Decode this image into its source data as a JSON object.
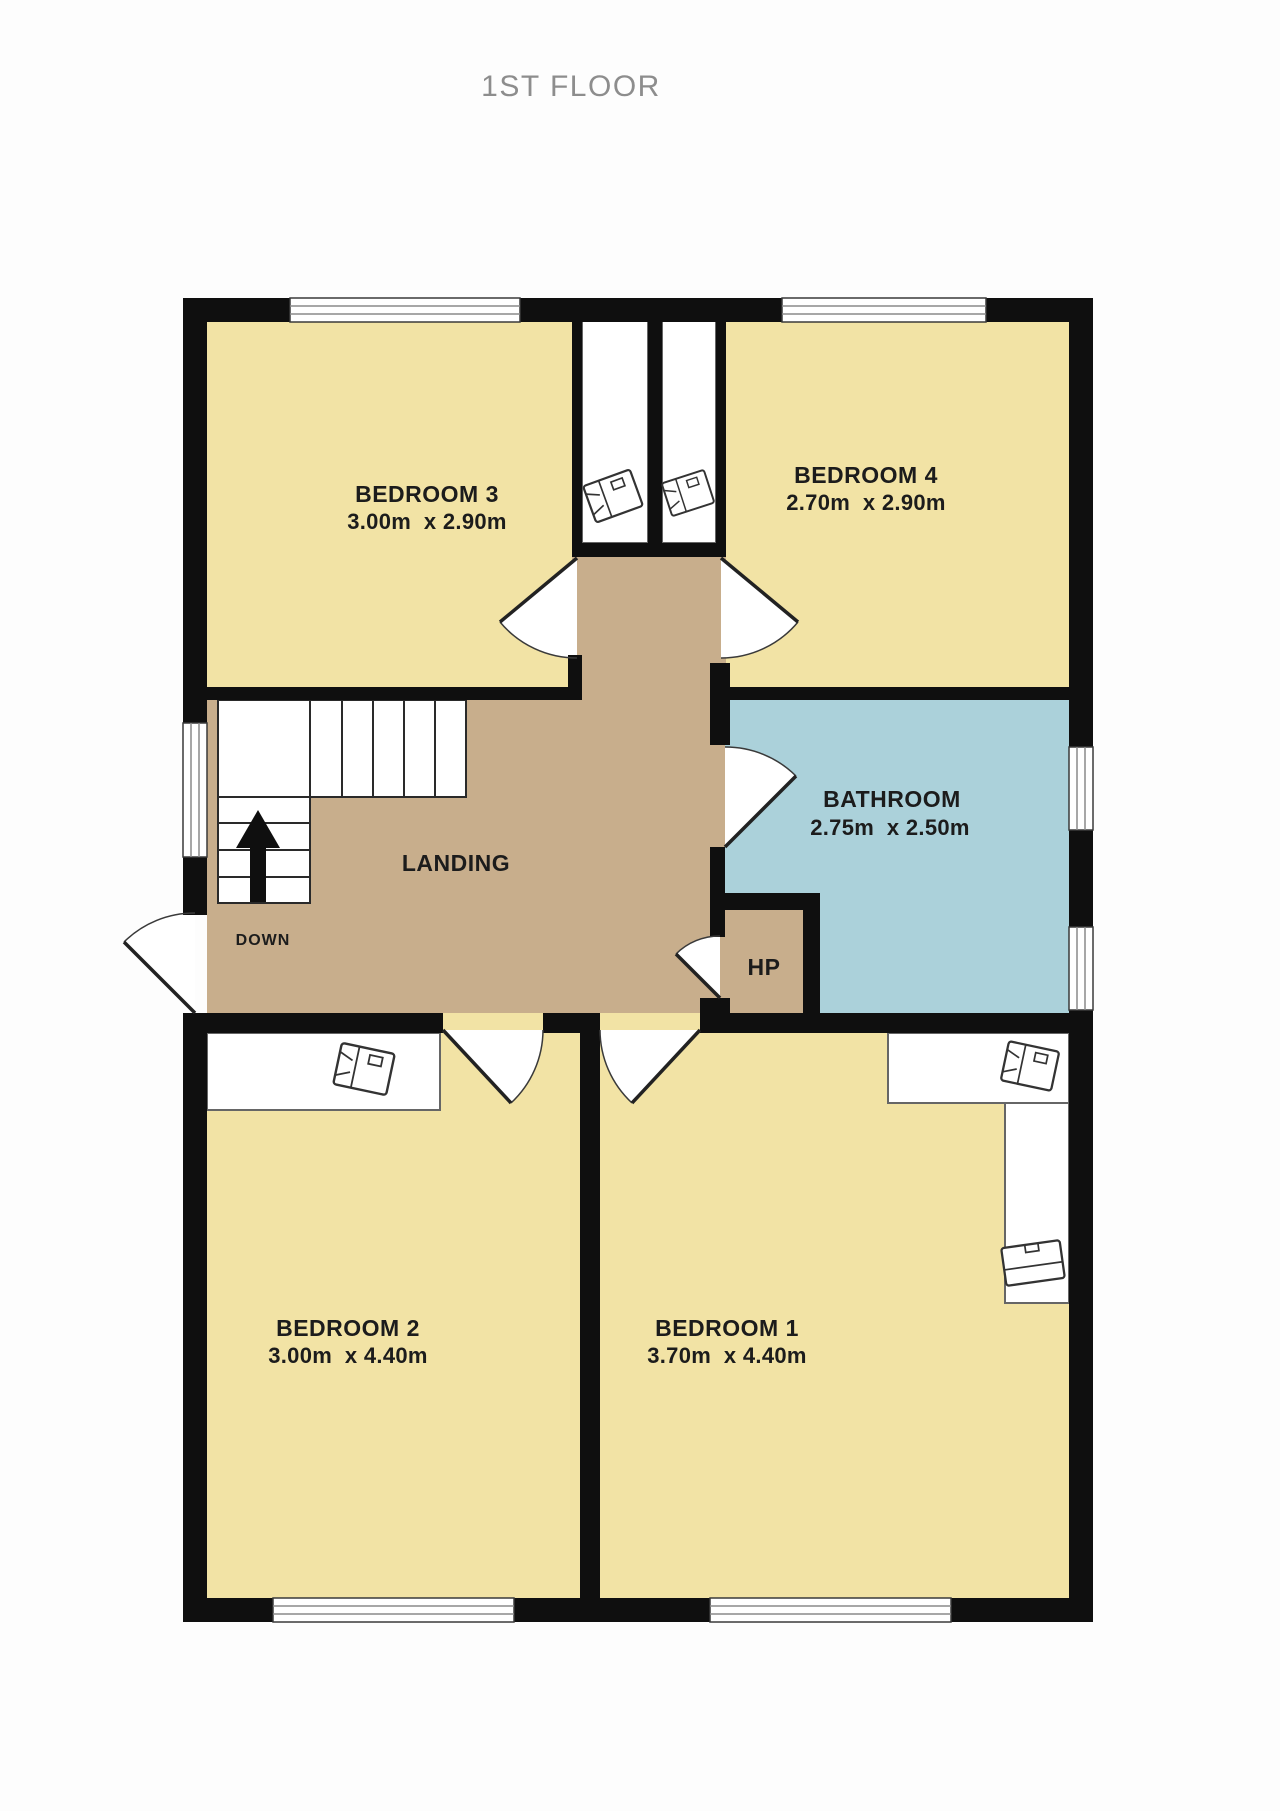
{
  "title": "1ST FLOOR",
  "colors": {
    "wall": "#0f0f0f",
    "bedroom_floor": "#F2E3A5",
    "landing_floor": "#C8AE8C",
    "bathroom_floor": "#ABD1DA",
    "title_text": "#8d8d8d",
    "label_text": "#1c1c1c"
  },
  "rooms": {
    "bedroom3": {
      "name": "BEDROOM 3",
      "dims": "3.00m  x 2.90m"
    },
    "bedroom4": {
      "name": "BEDROOM 4",
      "dims": "2.70m  x 2.90m"
    },
    "bathroom": {
      "name": "BATHROOM",
      "dims": "2.75m  x 2.50m"
    },
    "bedroom2": {
      "name": "BEDROOM 2",
      "dims": "3.00m  x 4.40m"
    },
    "bedroom1": {
      "name": "BEDROOM 1",
      "dims": "3.70m  x 4.40m"
    },
    "landing": {
      "name": "LANDING"
    },
    "hp": {
      "name": "HP"
    }
  },
  "stairs": {
    "direction_label": "DOWN"
  }
}
